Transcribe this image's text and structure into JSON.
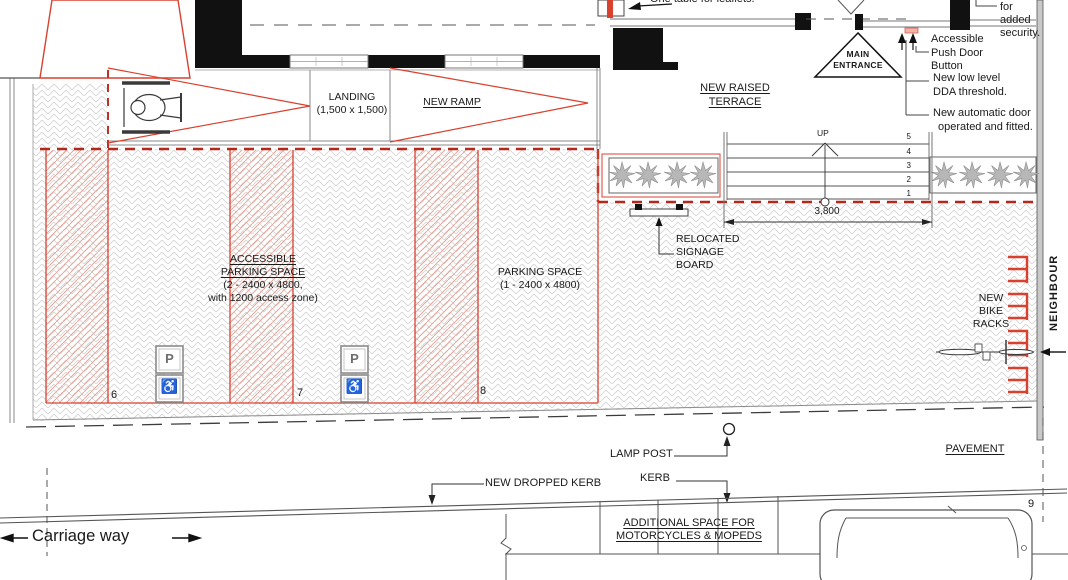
{
  "building": {
    "leaflet_note": "One table for leaflets.",
    "main_entrance": [
      "MAIN",
      "ENTRANCE"
    ]
  },
  "notes": {
    "security": [
      "gate",
      "for",
      "added",
      "security."
    ],
    "push_button": [
      "Accessible",
      "Push Door",
      "Button"
    ],
    "dda": [
      "New low level",
      "DDA threshold."
    ],
    "auto_door": [
      "New automatic door",
      "operated and fitted."
    ]
  },
  "ramp": {
    "landing": [
      "LANDING",
      "(1,500 x 1,500)"
    ],
    "new_ramp": "NEW RAMP"
  },
  "terrace": {
    "label": [
      "NEW RAISED",
      "TERRACE"
    ],
    "up": "UP",
    "steps": [
      "5",
      "4",
      "3",
      "2",
      "1"
    ],
    "dim": "3,800",
    "signage": [
      "RELOCATED",
      "SIGNAGE",
      "BOARD"
    ]
  },
  "parking": {
    "accessible": [
      "ACCESSIBLE",
      "PARKING SPACE",
      "(2 - 2400 x 4800,",
      "with 1200 access zone)"
    ],
    "standard": [
      "PARKING SPACE",
      "(1 - 2400 x 4800)"
    ],
    "bays": [
      "6",
      "7",
      "8"
    ],
    "bay9": "9",
    "sign_p": "P",
    "sign_wheelchair": "♿"
  },
  "east": {
    "bike_racks": [
      "NEW",
      "BIKE",
      "RACKS"
    ],
    "neighbour": "NEIGHBOUR"
  },
  "street": {
    "lamp_post": "LAMP POST",
    "kerb": "KERB",
    "dropped_kerb": "NEW DROPPED KERB",
    "pavement": "PAVEMENT",
    "carriage_way": "Carriage way",
    "moto": [
      "ADDITIONAL SPACE FOR",
      "MOTORCYCLES & MOPEDS"
    ]
  },
  "colors": {
    "accent_red": "#d9412f",
    "boundary_red_dash": "#b5271b",
    "line_dark": "#333333",
    "paving_gray": "#d6d6d6"
  }
}
